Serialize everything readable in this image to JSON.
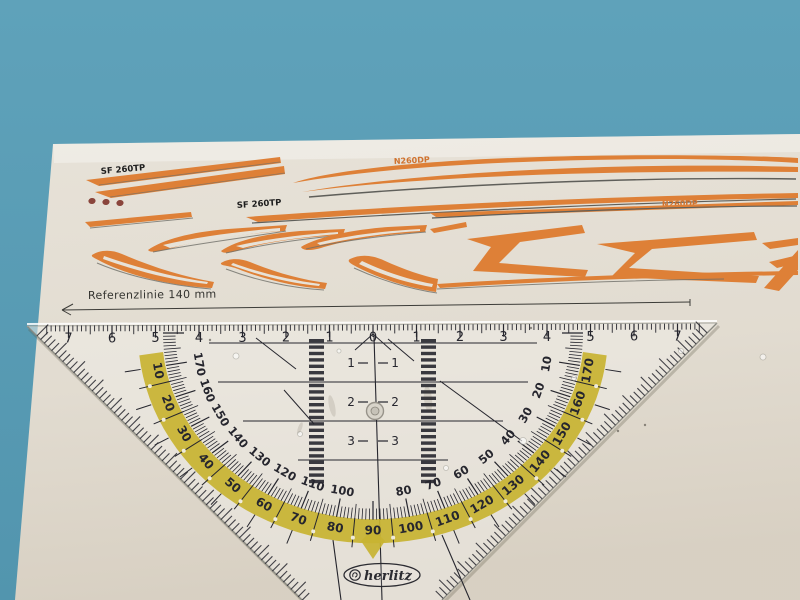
{
  "scene": {
    "background_color": "#5a9db6",
    "paper_color": "#e7e2d8"
  },
  "decals": {
    "label_sf260_left": "SF 260TP",
    "label_sf260_mid": "SF 260TP",
    "label_n260_top": "N260DP",
    "label_n260_right": "N260DP",
    "orange": "#de8037",
    "outline_gray": "#6e6e68",
    "dot_color": "#8a453c"
  },
  "reference": {
    "label": "Referenzlinie 140 mm"
  },
  "ruler": {
    "brand": "herlitz",
    "print_color": "#26262e",
    "band_color": "#c8b331",
    "cm_labels": [
      7,
      6,
      5,
      4,
      3,
      2,
      1,
      0,
      1,
      2,
      3,
      4,
      5,
      6,
      7
    ],
    "protractor_outer_labels": [
      10,
      20,
      30,
      40,
      50,
      60,
      70,
      80,
      90,
      100,
      110,
      120,
      130,
      140,
      150,
      160,
      170
    ],
    "protractor_inner_labels": [
      170,
      160,
      150,
      140,
      130,
      120,
      110,
      100,
      80,
      70,
      60,
      50,
      40,
      30,
      20,
      10
    ],
    "parallel_guide_labels": [
      1,
      2,
      3
    ]
  }
}
